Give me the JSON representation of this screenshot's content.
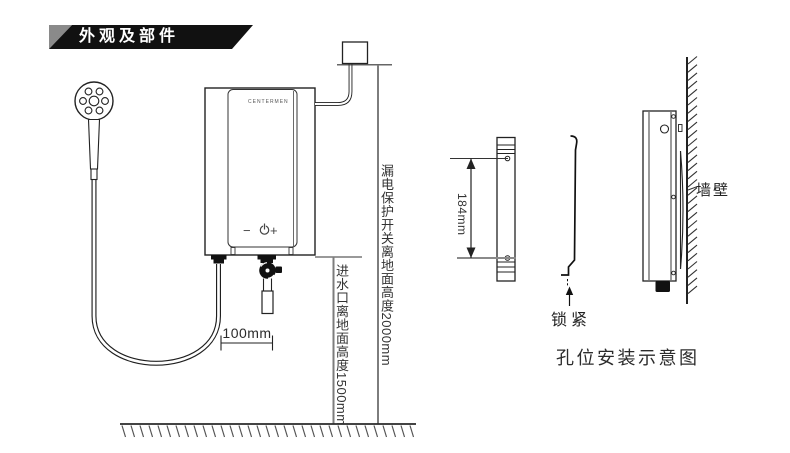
{
  "header": {
    "title": "外观及部件"
  },
  "front_diagram": {
    "heater": {
      "brand": "CENTERMEN",
      "controls": {
        "minus": "−",
        "power_icon": "power-icon",
        "plus": "+"
      }
    },
    "annotations": {
      "breaker_height": "漏电保护开关离地面高度2000mm",
      "inlet_height": "进水口离地面高度1500mm",
      "outlet_distance": "100mm"
    }
  },
  "install_diagram": {
    "bracket_length": "184mm",
    "lock_label": "锁紧",
    "wall_label": "墙壁",
    "caption": "孔位安装示意图"
  },
  "colors": {
    "banner": "#111111",
    "banner_accent": "#8a8a8a",
    "ink": "#1f1f1f",
    "measure_line": "#7d7d7d",
    "text": "#333333"
  }
}
